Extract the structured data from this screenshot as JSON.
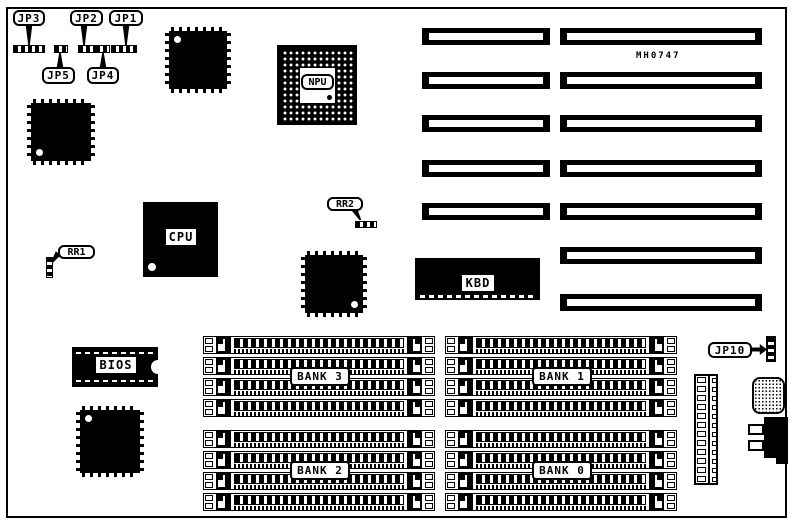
{
  "board": {
    "part_number": "MH0747",
    "ink": "#000000",
    "paper": "#ffffff"
  },
  "jumpers": {
    "jp1": {
      "label": "JP1"
    },
    "jp2": {
      "label": "JP2"
    },
    "jp3": {
      "label": "JP3"
    },
    "jp4": {
      "label": "JP4"
    },
    "jp5": {
      "label": "JP5"
    },
    "jp10": {
      "label": "JP10"
    }
  },
  "resistor_packs": {
    "rr1": {
      "label": "RR1"
    },
    "rr2": {
      "label": "RR2"
    }
  },
  "chips": {
    "cpu": {
      "label": "CPU"
    },
    "npu": {
      "label": "NPU"
    },
    "kbd": {
      "label": "KBD"
    },
    "bios": {
      "label": "BIOS"
    }
  },
  "memory_banks": [
    {
      "label": "BANK 3",
      "x": 203,
      "y": 336
    },
    {
      "label": "BANK 1",
      "x": 445,
      "y": 336
    },
    {
      "label": "BANK 2",
      "x": 203,
      "y": 430
    },
    {
      "label": "BANK 0",
      "x": 445,
      "y": 430
    }
  ],
  "memory_socket": {
    "width": 232,
    "height": 18,
    "pitch": 21,
    "count": 4
  },
  "isa_slots": {
    "height": 17,
    "columns": [
      {
        "x": 422,
        "width": 128,
        "rows_y": [
          28,
          72,
          115,
          160,
          203
        ]
      },
      {
        "x": 560,
        "width": 202,
        "rows_y": [
          28,
          72,
          115,
          160,
          203,
          247,
          294
        ]
      }
    ]
  },
  "qfp_chips": [
    {
      "x": 165,
      "y": 27,
      "w": 66,
      "h": 66,
      "dot": "tl"
    },
    {
      "x": 27,
      "y": 99,
      "w": 68,
      "h": 66,
      "dot": "bl"
    },
    {
      "x": 301,
      "y": 251,
      "w": 66,
      "h": 66,
      "dot": "br"
    },
    {
      "x": 76,
      "y": 406,
      "w": 68,
      "h": 71,
      "dot": "tl"
    }
  ],
  "power_connector": {
    "pin_rows": 12
  }
}
